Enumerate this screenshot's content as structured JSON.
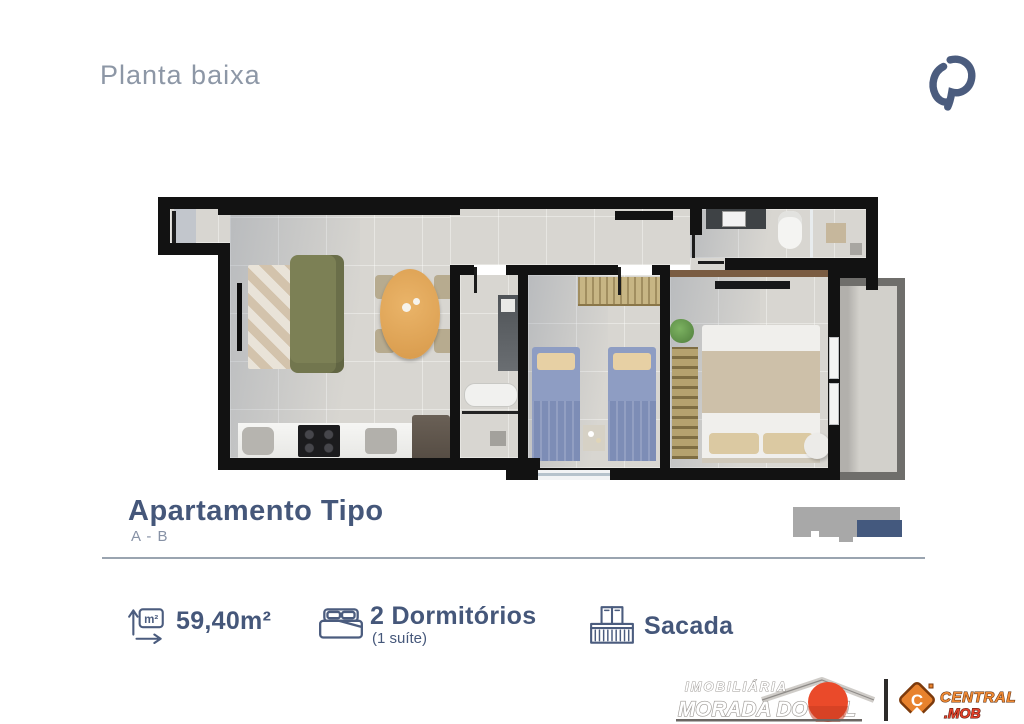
{
  "header": {
    "title": "Planta baixa"
  },
  "unit": {
    "title": "Apartamento Tipo",
    "subtitle": "A - B"
  },
  "features": {
    "area": {
      "value": "59,40m²",
      "icon_label": "m²"
    },
    "bedrooms": {
      "value": "2 Dormitórios",
      "note": "(1 suíte)"
    },
    "balcony": {
      "value": "Sacada"
    }
  },
  "footer": {
    "agency": {
      "line1": "IMOBILIÁRIA",
      "line2": "MORADA DO SOL"
    },
    "platform": {
      "monogram": "C",
      "line1": "CENTRAL",
      "line2": ".MOB"
    }
  },
  "colors": {
    "heading": "#8d97a6",
    "title": "#45577a",
    "divider": "#9aa4b0",
    "wall": "#121212",
    "floor": "#d8d6d1",
    "sofa_green": "#7c8055",
    "table_wood": "#dfa259",
    "bed_blue": "#8e9dc3",
    "wardrobe_tan": "#c7b584",
    "suite_blanket": "#cdc0a9",
    "balcony_rail": "#6f6e6b",
    "keyplan_gray": "#a8a8a8",
    "keyplan_blue": "#44597e",
    "sun_red": "#ea4a2a",
    "mob_orange": "#e8822d"
  }
}
